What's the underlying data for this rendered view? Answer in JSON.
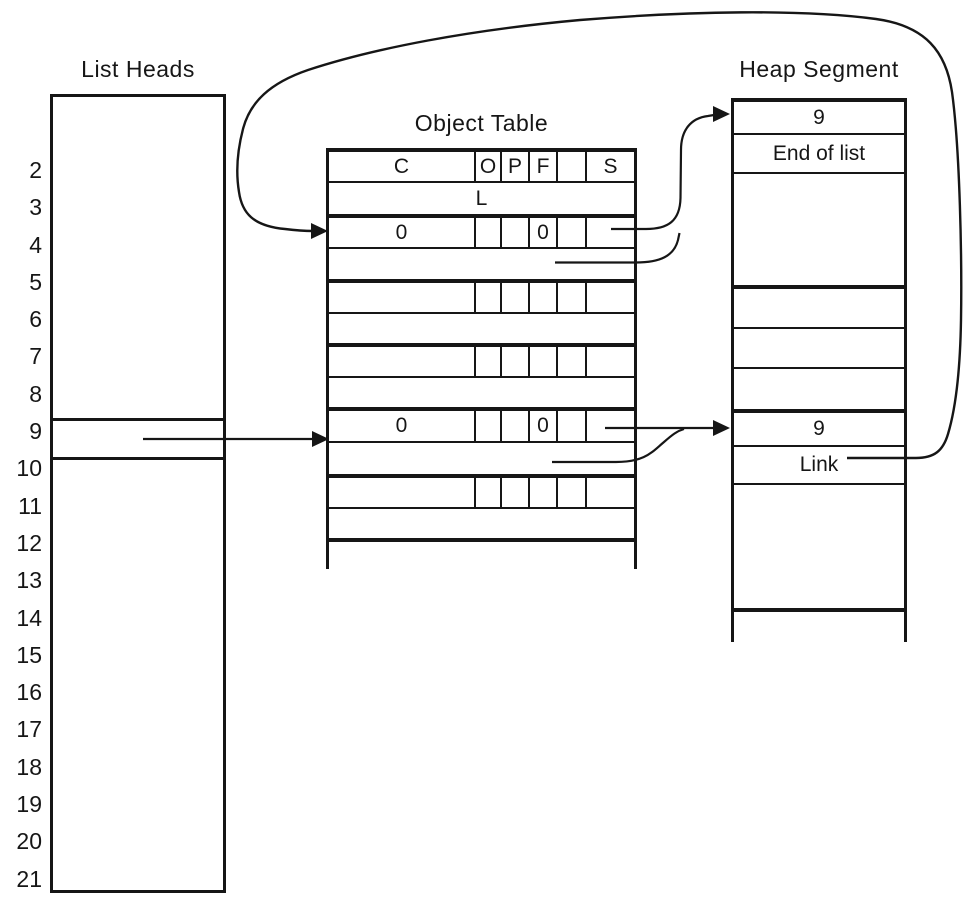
{
  "list_heads": {
    "title": "List Heads",
    "indices": [
      "2",
      "3",
      "4",
      "5",
      "6",
      "7",
      "8",
      "9",
      "10",
      "11",
      "12",
      "13",
      "14",
      "15",
      "16",
      "17",
      "18",
      "19",
      "20",
      "21"
    ]
  },
  "object_table": {
    "title": "Object Table",
    "header": {
      "c": "C",
      "o": "O",
      "p": "P",
      "f": "F",
      "spare": "",
      "s": "S"
    },
    "location_row": "L",
    "entries": [
      {
        "c": "0",
        "o": "",
        "p": "",
        "f": "0",
        "spare": "",
        "s": ""
      },
      {
        "c": "",
        "o": "",
        "p": "",
        "f": "",
        "spare": "",
        "s": ""
      },
      {
        "c": "",
        "o": "",
        "p": "",
        "f": "",
        "spare": "",
        "s": ""
      },
      {
        "c": "0",
        "o": "",
        "p": "",
        "f": "0",
        "spare": "",
        "s": ""
      },
      {
        "c": "",
        "o": "",
        "p": "",
        "f": "",
        "spare": "",
        "s": ""
      }
    ]
  },
  "heap_segment": {
    "title": "Heap Segment",
    "block_top": {
      "size": "9",
      "marker": "End of list"
    },
    "block_bottom": {
      "size": "9",
      "marker": "Link"
    }
  }
}
